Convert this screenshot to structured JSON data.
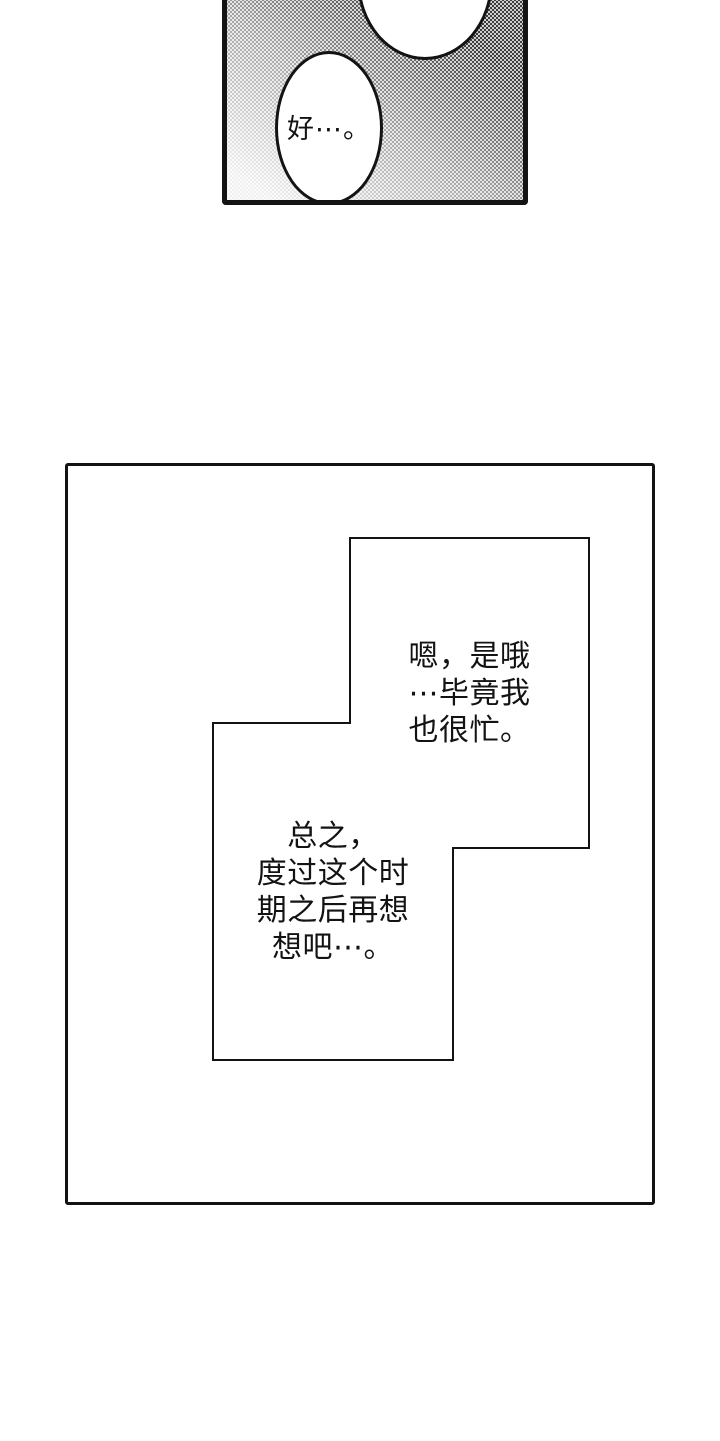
{
  "panel_top": {
    "bubble_text": "好⋯。"
  },
  "panel_main": {
    "box_right": {
      "lines": [
        "嗯，是哦",
        "⋯毕竟我",
        "也很忙。"
      ]
    },
    "box_left": {
      "lines": [
        "总之，",
        "度过这个时",
        "期之后再想",
        "想吧⋯。"
      ]
    }
  },
  "colors": {
    "ink": "#131313",
    "paper": "#ffffff",
    "halftone_dot": "#3c3c3c"
  }
}
